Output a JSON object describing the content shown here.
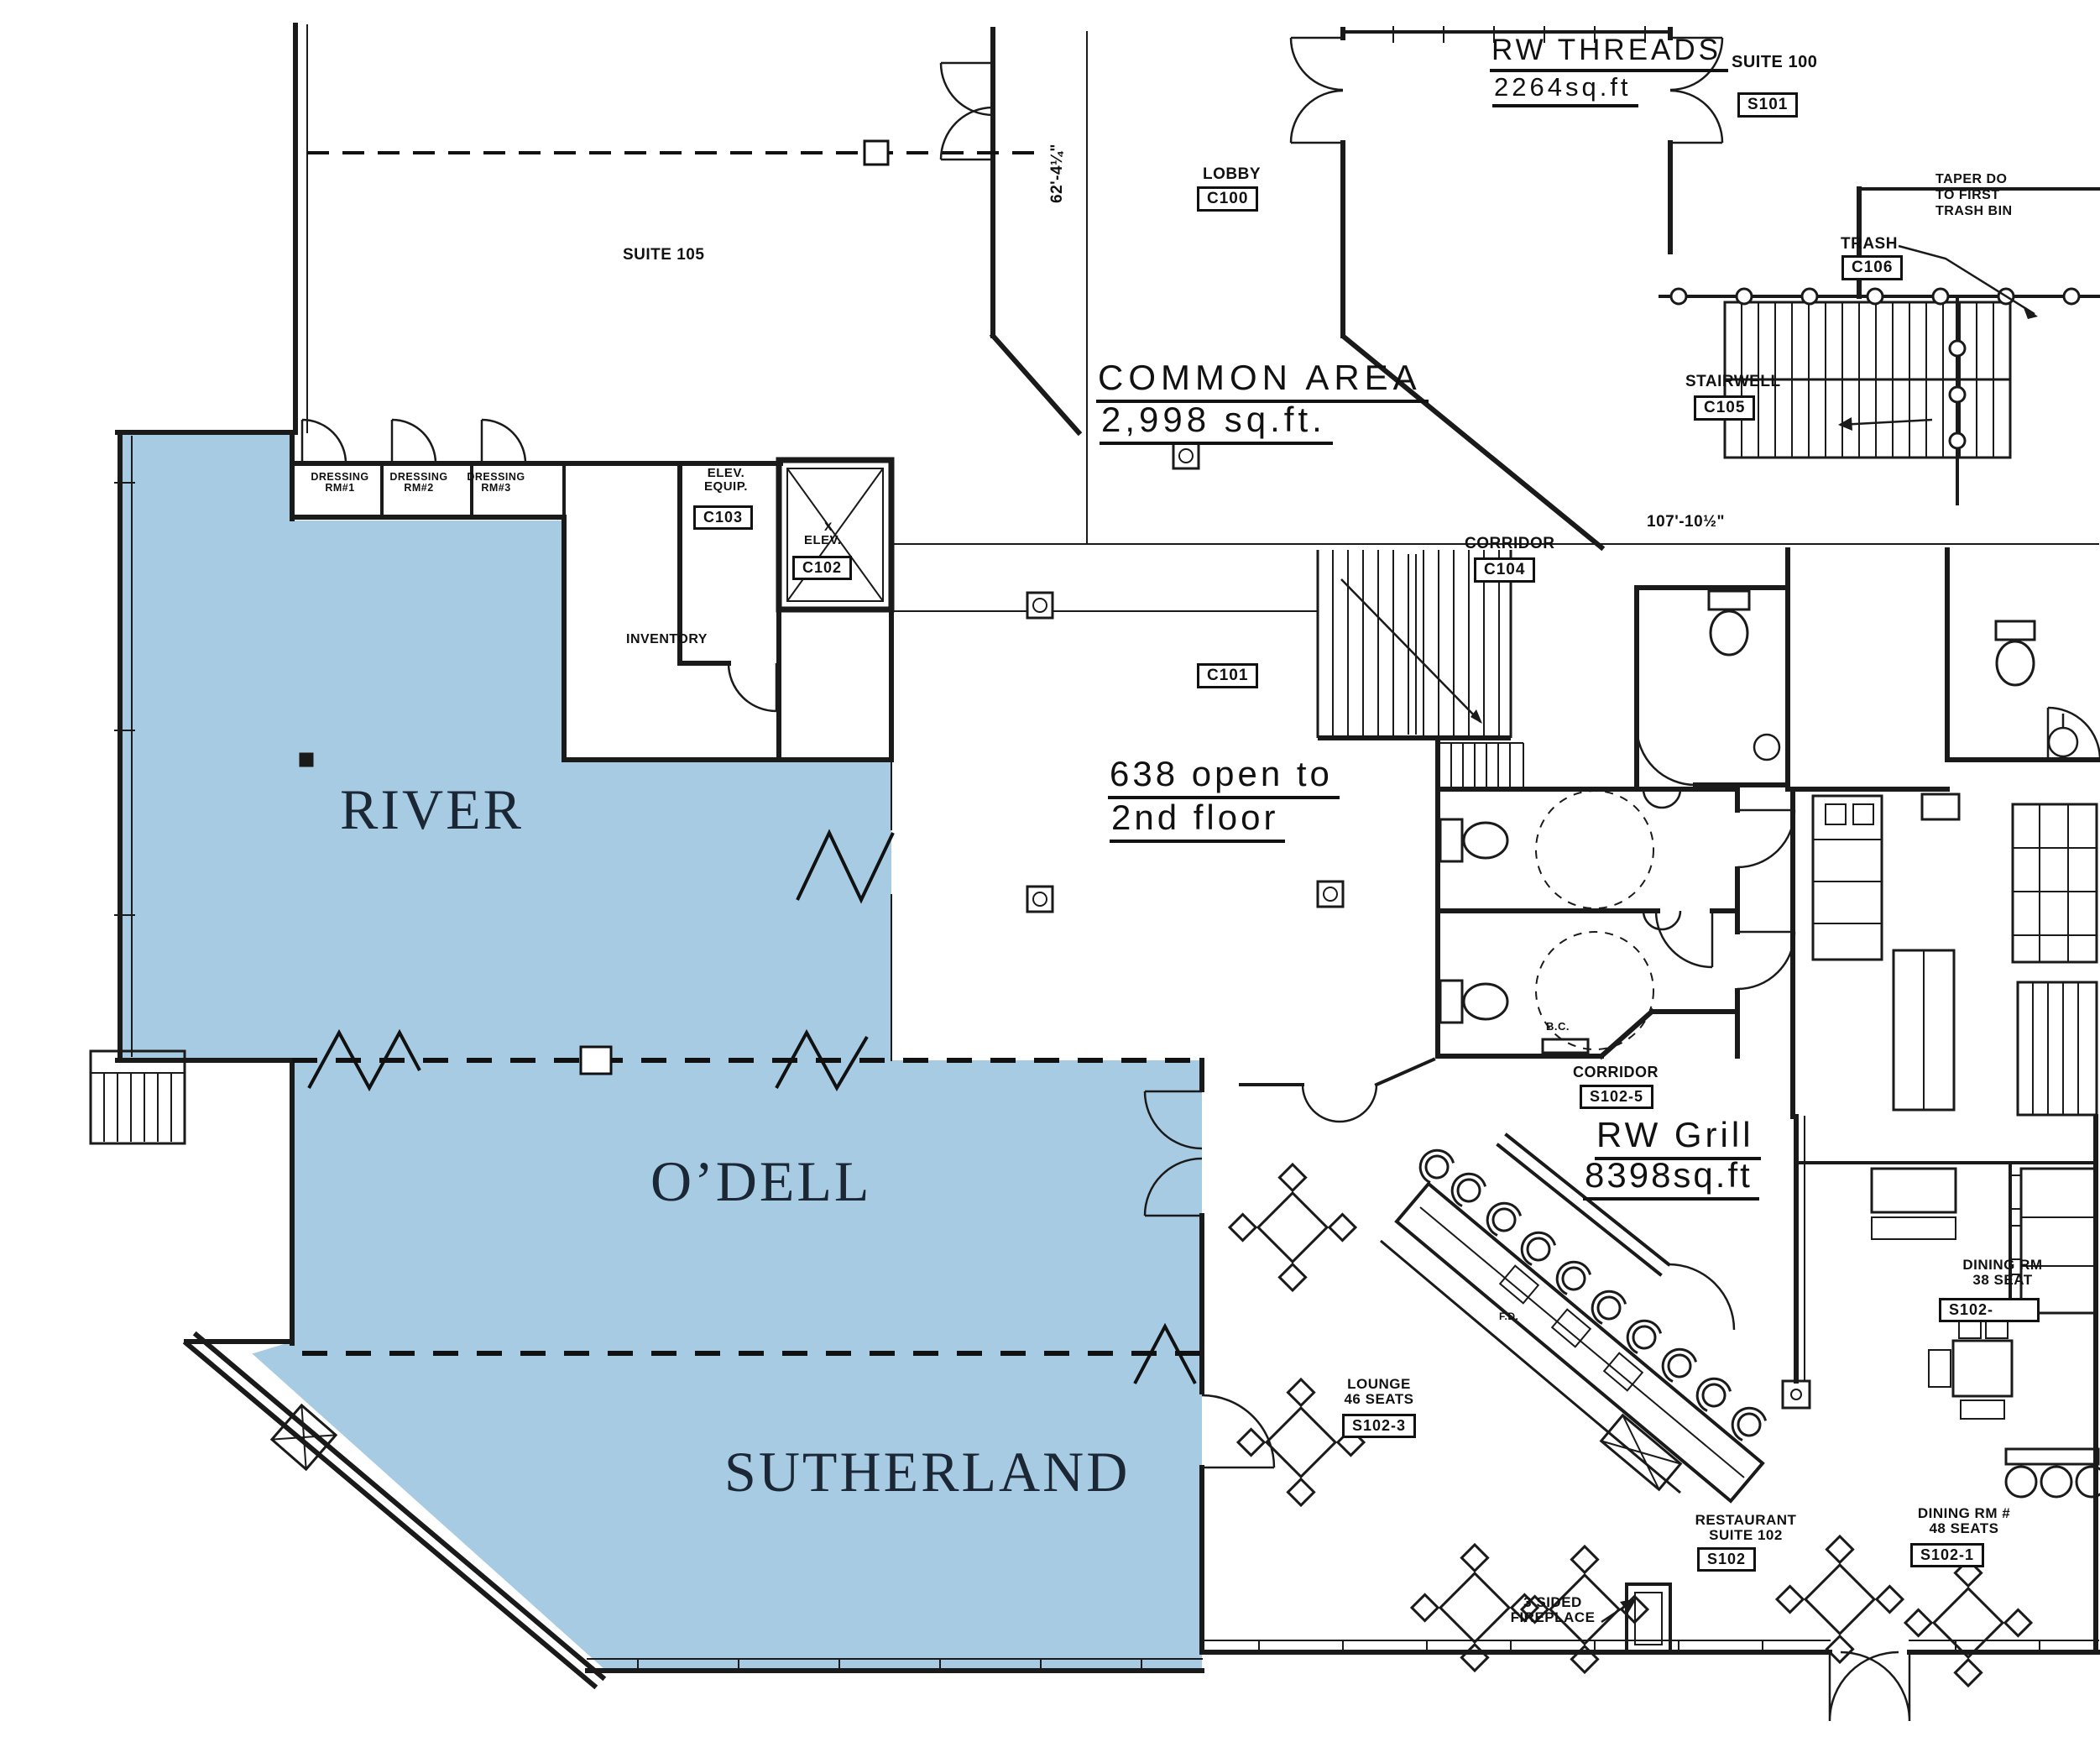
{
  "title": "First floor leasing plan",
  "colors": {
    "highlight": "#a6cbe2",
    "room_label_text": "#1b2735",
    "linework": "#1a1a1a"
  },
  "highlighted_rooms": [
    {
      "name": "RIVER"
    },
    {
      "name": "O’DELL"
    },
    {
      "name": "SUTHERLAND"
    }
  ],
  "labels": {
    "river": "RIVER",
    "odell": "O’DELL",
    "sutherland": "SUTHERLAND",
    "rw_threads_name": "RW THREADS",
    "rw_threads_area": "2264sq.ft",
    "suite_100": "SUITE 100",
    "s101": "S101",
    "taper_1": "TAPER DO",
    "taper_2": "TO FIRST",
    "taper_3": "TRASH BIN",
    "trash": "TRASH",
    "c106": "C106",
    "lobby": "LOBBY",
    "c100": "C100",
    "common_area": "COMMON AREA",
    "common_area_sqft": "2,998 sq.ft.",
    "stairwell": "STAIRWELL",
    "c105": "C105",
    "suite_105": "SUITE 105",
    "elev_equip_1": "ELEV.",
    "elev_equip_2": "EQUIP.",
    "c103": "C103",
    "elev_x": "X",
    "elev": "ELEV.",
    "c102": "C102",
    "inventory": "INVENTORY",
    "corridor_c104": "CORRIDOR",
    "c104": "C104",
    "dim_h": "107'-10½\"",
    "dim_v": "62'-4¼\"",
    "c101": "C101",
    "open_638_1": "638 open to",
    "open_638_2": "2nd floor",
    "corridor_s102_5": "CORRIDOR",
    "s102_5": "S102-5",
    "rw_grill_name": "RW Grill",
    "rw_grill_area": "8398sq.ft",
    "lounge_1": "LOUNGE",
    "lounge_2": "46 SEATS",
    "s102_3": "S102-3",
    "fd": "F.D.",
    "bc": "B.C.",
    "restaurant_1": "RESTAURANT",
    "restaurant_2": "SUITE 102",
    "s102": "S102",
    "dining48_1": "DINING RM #",
    "dining48_2": "48 SEATS",
    "s102_1": "S102-1",
    "dining38_1": "DINING RM",
    "dining38_2": "38 SEAT",
    "s102_x": "S102-",
    "fireplace_1": "3 SIDED",
    "fireplace_2": "FIREPLACE"
  },
  "dressing_rooms": [
    {
      "line1": "DRESSING",
      "line2": "RM#1"
    },
    {
      "line1": "DRESSING",
      "line2": "RM#2"
    },
    {
      "line1": "DRESSING",
      "line2": "RM#3"
    }
  ],
  "areas": {
    "rw_threads_sqft": "2264sq.ft",
    "common_area_sqft": "2,998 sq.ft.",
    "rw_grill_sqft": "8398sq.ft"
  }
}
